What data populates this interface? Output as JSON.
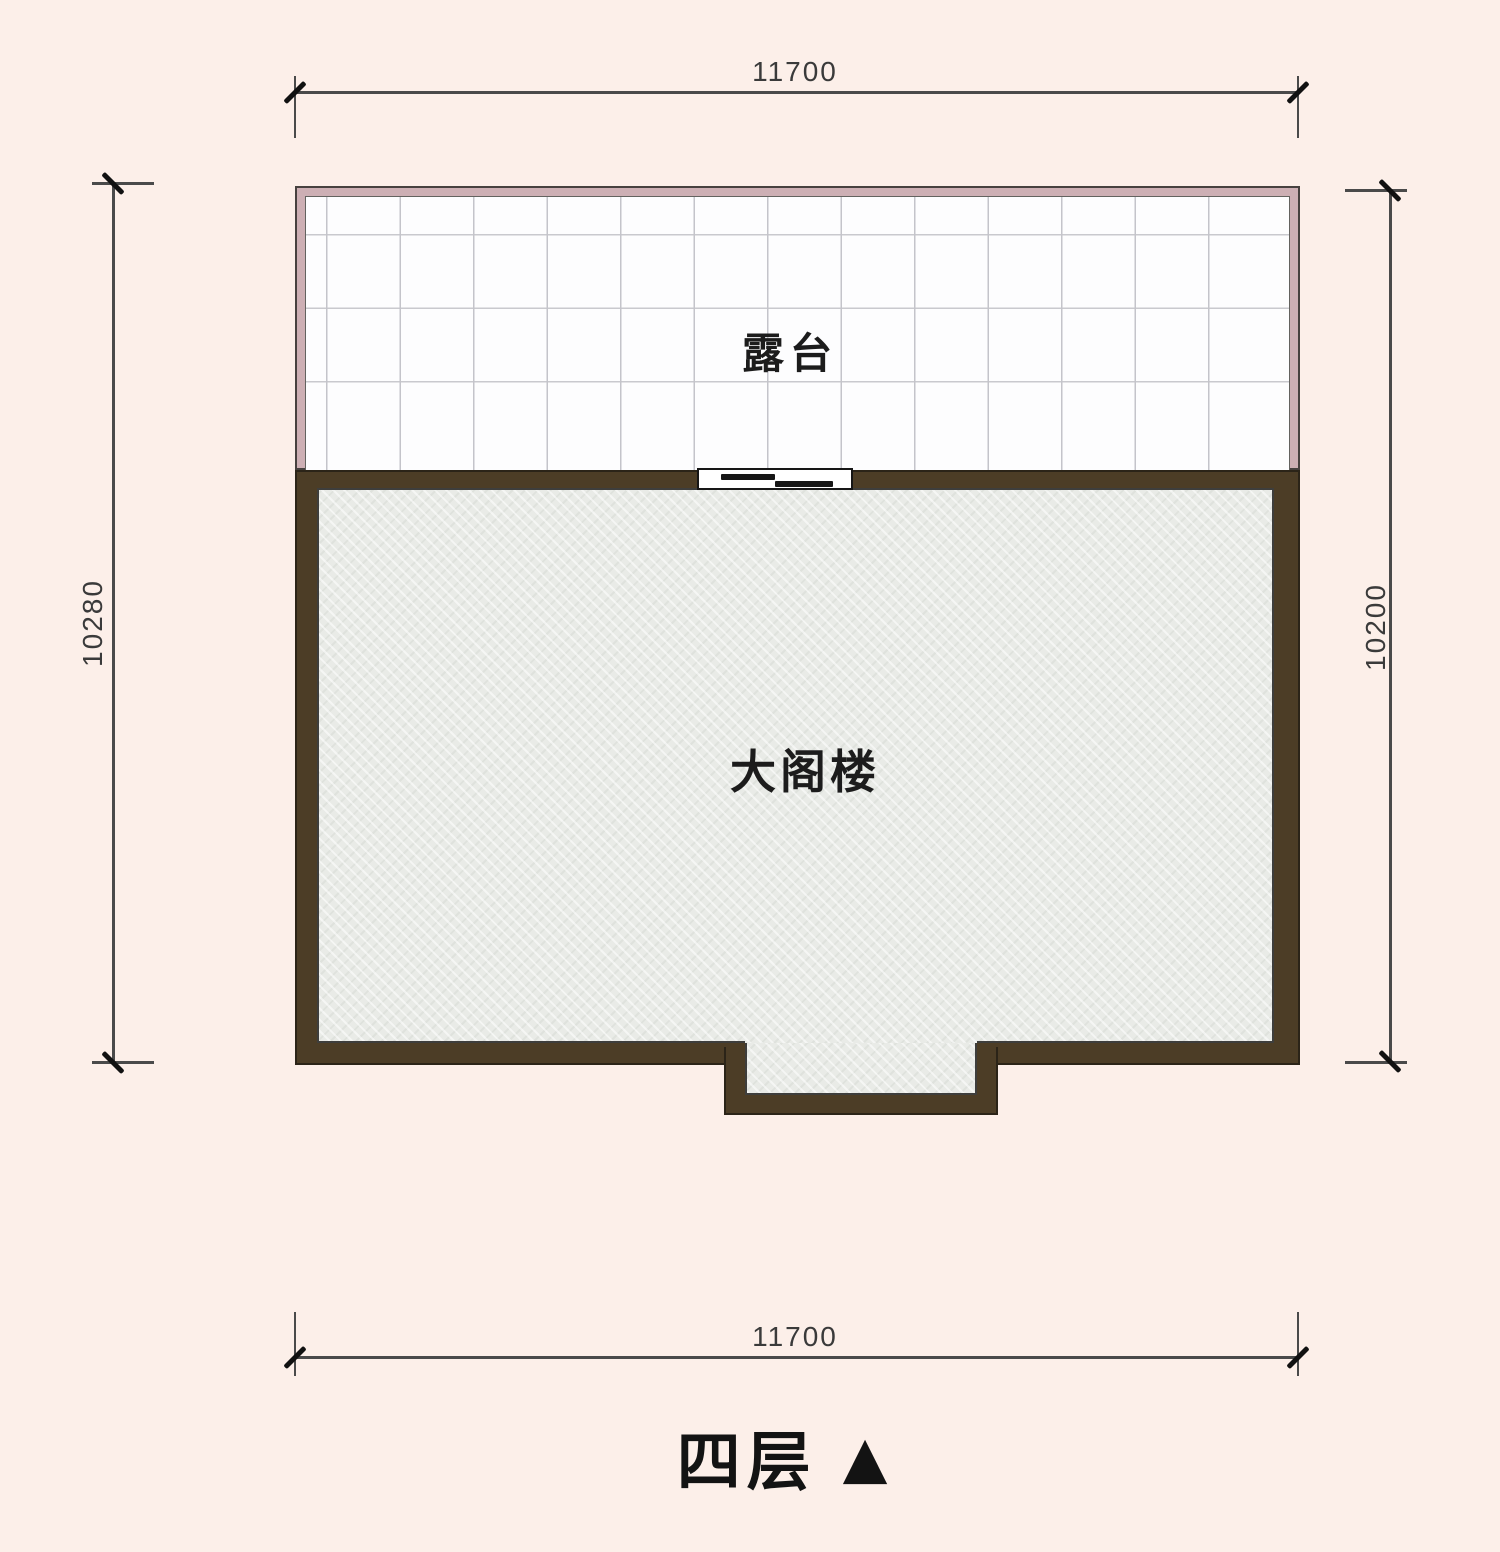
{
  "colors": {
    "background": "#fcefe9",
    "wall_brown": "#4c3d26",
    "terrace_wall_pink": "#cdafb4",
    "floor_gray": "#e9ebe7",
    "grid_line": "#c4c4ca",
    "dimension_line": "#4a4a4a",
    "text": "#1c1c1c"
  },
  "dimensions": {
    "top": {
      "label": "11700"
    },
    "bottom": {
      "label": "11700"
    },
    "left": {
      "label": "10280"
    },
    "right": {
      "label": "10200"
    }
  },
  "rooms": {
    "terrace": {
      "label": "露台"
    },
    "attic": {
      "label": "大阁楼"
    }
  },
  "title": {
    "floor": "四层",
    "marker": "▲"
  }
}
